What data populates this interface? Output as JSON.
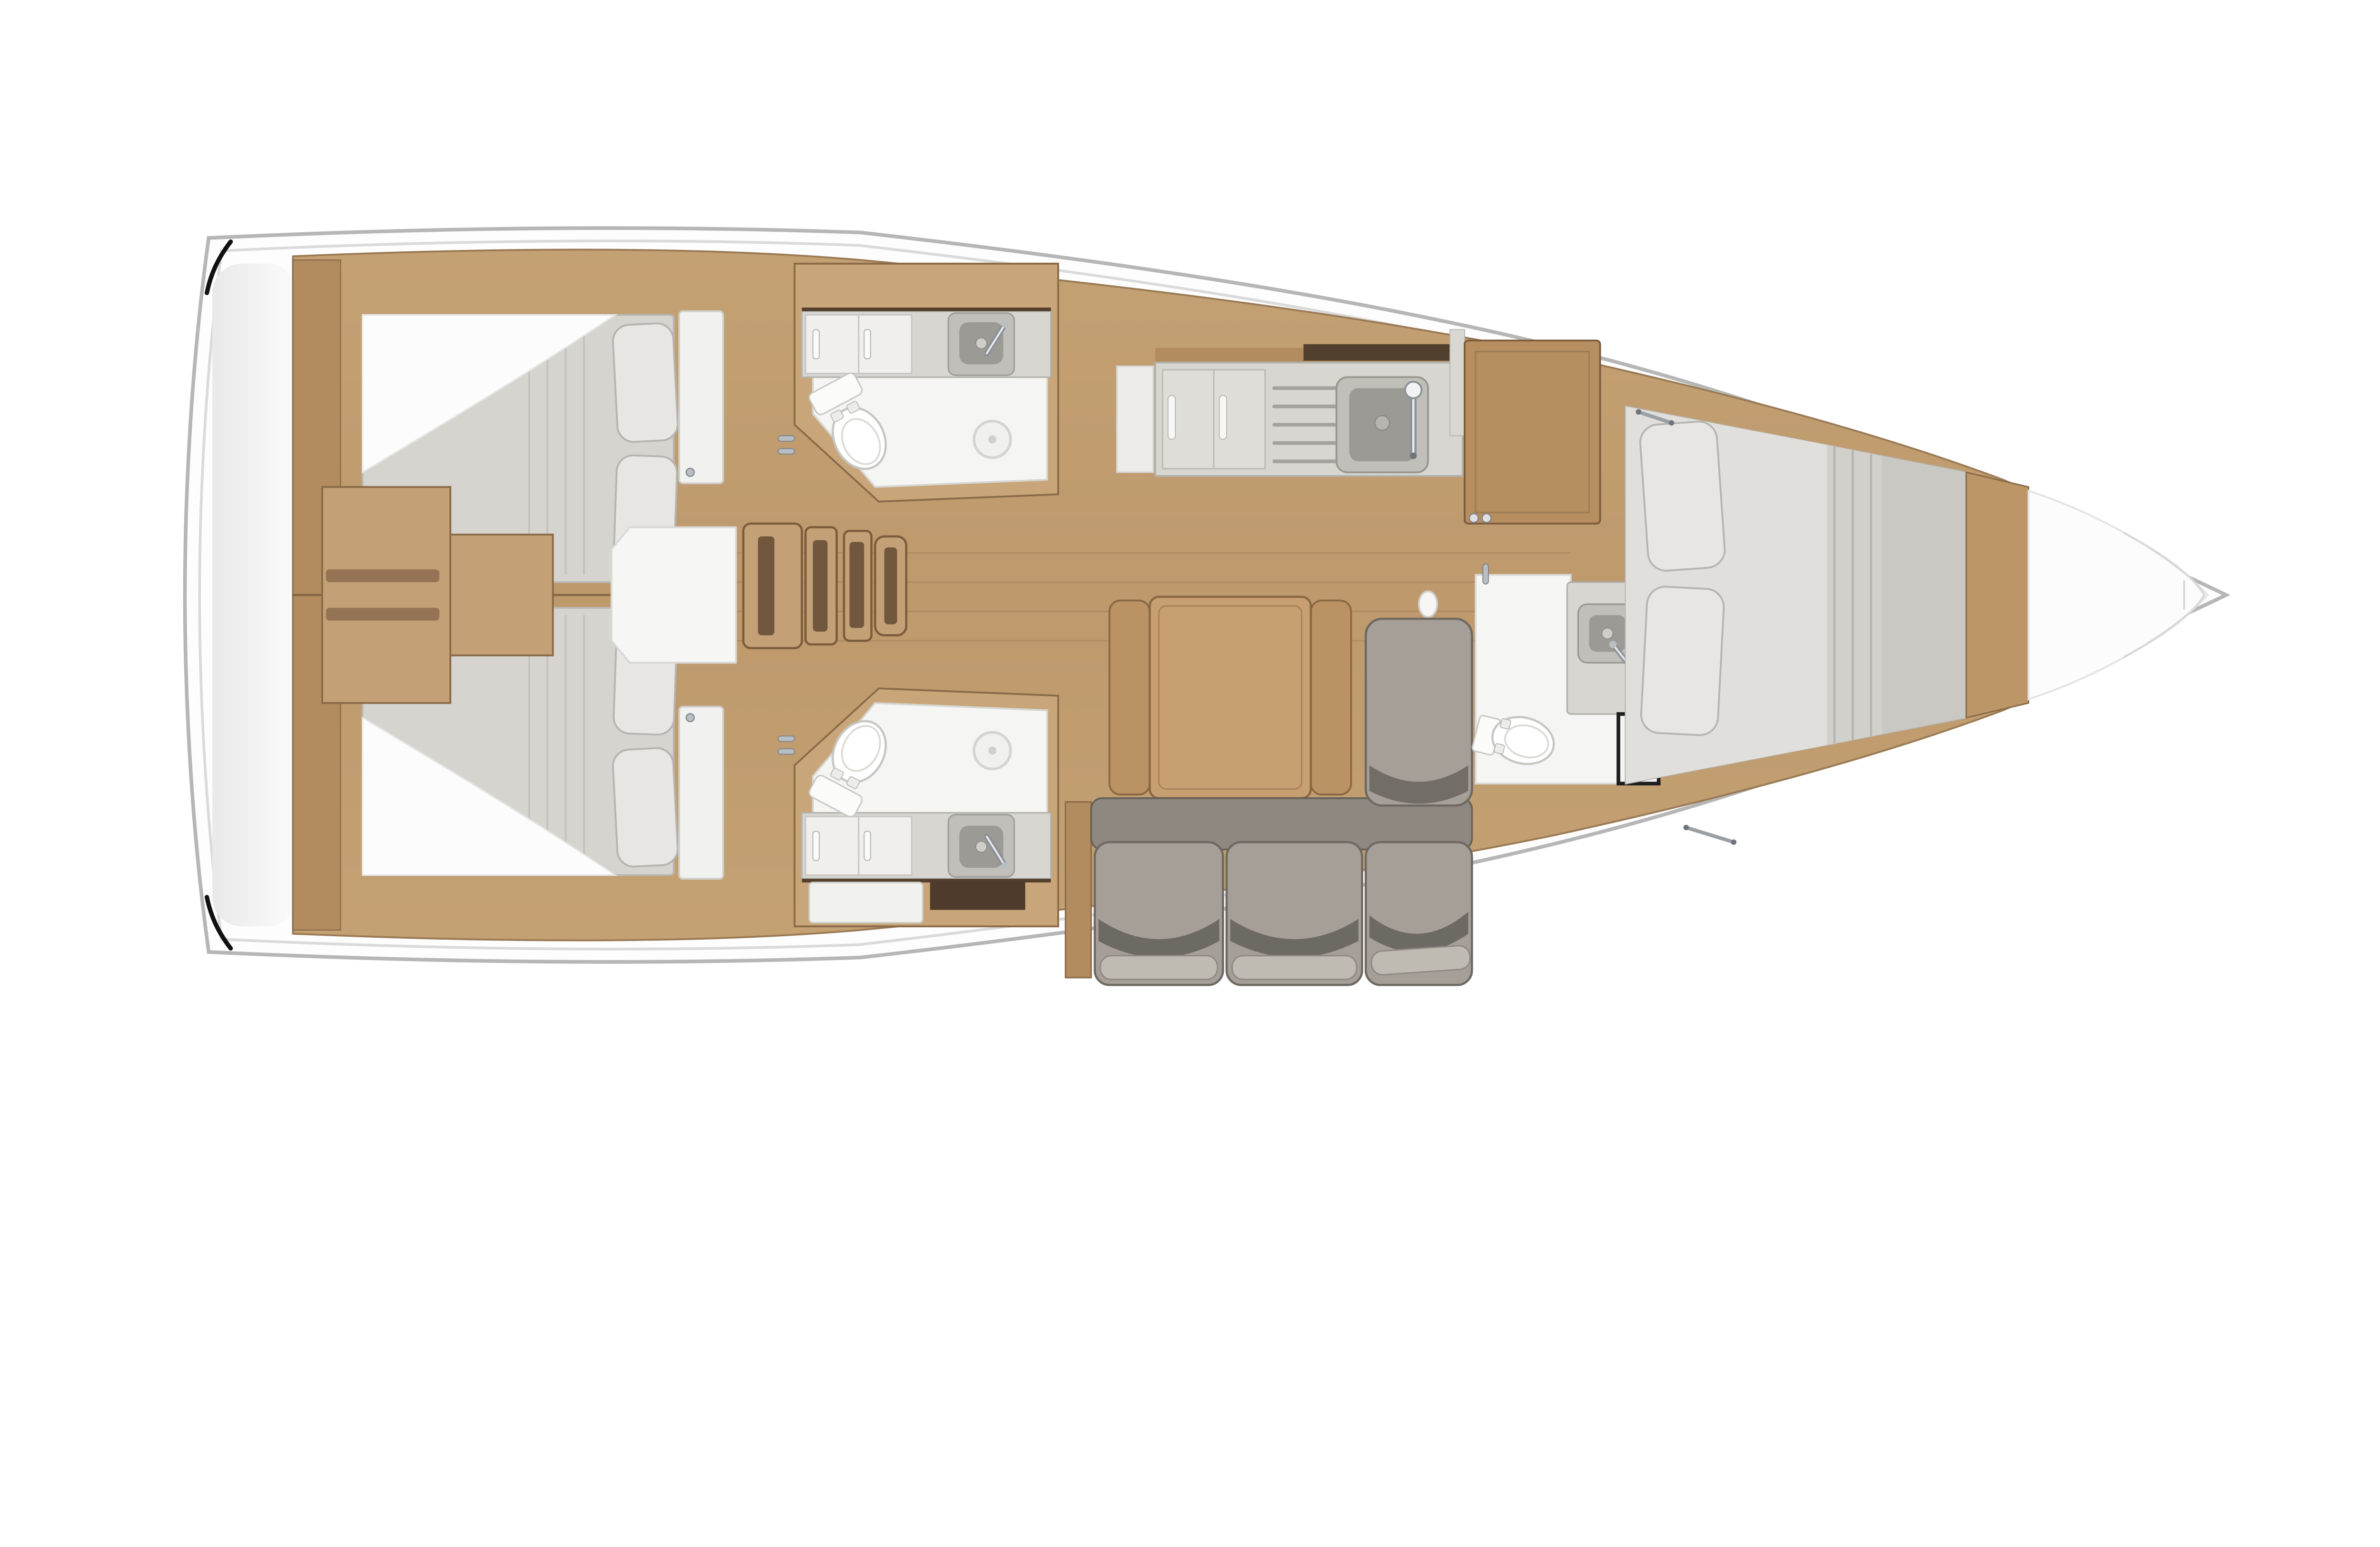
{
  "meta": {
    "type": "yacht-interior-floorplan",
    "view": "top-down",
    "orientation": "bow-right-stern-left",
    "label": "Sailing yacht interior layout plan, top view: three cabins, three heads, galley and salon"
  },
  "counts": {
    "cabins": 3,
    "heads": 3,
    "toilets": 3,
    "sinks": 4,
    "berth_pillows": 6,
    "settee_seat_cushions": 3,
    "companionway_treads": 4,
    "table_sections": 3
  },
  "rooms": [
    {
      "id": "stern-platform",
      "label": "Stern transom platform"
    },
    {
      "id": "aft-cabin-port",
      "label": "Aft double cabin, port side",
      "fixtures": [
        "double berth",
        "pillow x2",
        "cabin door"
      ]
    },
    {
      "id": "aft-cabin-starboard",
      "label": "Aft double cabin, starboard side",
      "fixtures": [
        "double berth",
        "pillow x2",
        "cabin door"
      ]
    },
    {
      "id": "engine-box",
      "label": "Engine / step box between aft berths"
    },
    {
      "id": "companionway",
      "label": "Companionway steps with landing",
      "fixtures": [
        "tread x4"
      ]
    },
    {
      "id": "head-port",
      "label": "Aft head with shower, port",
      "fixtures": [
        "toilet",
        "wash basin",
        "faucet",
        "shower drain",
        "vanity sliding cabinet"
      ]
    },
    {
      "id": "head-starboard",
      "label": "Aft head with shower, starboard",
      "fixtures": [
        "toilet",
        "wash basin",
        "faucet",
        "shower drain",
        "vanity sliding cabinet",
        "drawer"
      ]
    },
    {
      "id": "galley",
      "label": "Galley, port side",
      "fixtures": [
        "sliding-door cabinet",
        "drainer rack",
        "sink",
        "faucet"
      ]
    },
    {
      "id": "salon",
      "label": "Salon",
      "fixtures": [
        "folding table with two leaves",
        "L-shaped settee",
        "chaise cushion",
        "seat cushion x3"
      ]
    },
    {
      "id": "forward-head",
      "label": "Forward head, starboard",
      "fixtures": [
        "toilet",
        "wash basin",
        "faucet",
        "door"
      ]
    },
    {
      "id": "forward-cabin",
      "label": "Forward V-berth cabin",
      "fixtures": [
        "double berth",
        "pillow x2",
        "mattress gas struts"
      ]
    },
    {
      "id": "bow-locker",
      "label": "Bow anchor locker"
    }
  ],
  "colors": {
    "hull_fill": "#fdfdfd",
    "hull_stroke": "#b6b6b6",
    "deck_line": "#d9d9d9",
    "wood_base": "#bf9b6e",
    "wood_light": "#c8a679",
    "wood_mid": "#b28c5e",
    "wood_dark": "#8a6a48",
    "wood_table": "#c79f70",
    "wood_step": "#c4a076",
    "dark_trim": "#52402f",
    "black_trim": "#1e1e1e",
    "mattress": "#d6d4ce",
    "pillow": "#e7e6e3",
    "cushion": "#a59f97",
    "cushion_back": "#8e8880",
    "counter": "#d7d6d0",
    "cabinet_white": "#f0efec",
    "floor_white": "#f5f5f4",
    "sink_rim": "#c0bfb9",
    "sink_gray": "#9b9a94",
    "chrome": "#b9bec3"
  }
}
